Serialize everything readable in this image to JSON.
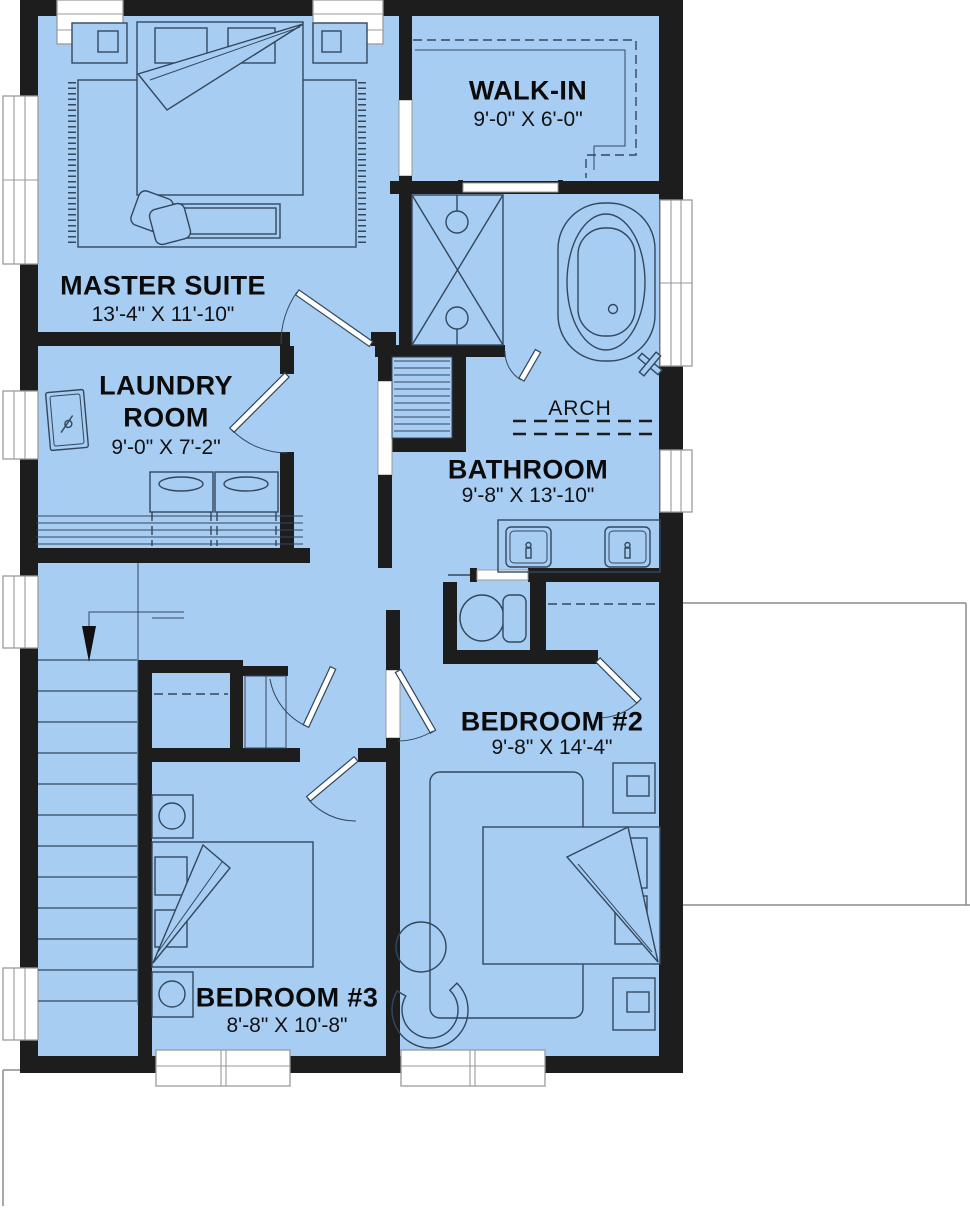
{
  "palette": {
    "floor": "#a8cdf3",
    "wall": "#1d1d1d",
    "line": "#33475c",
    "frame": "#9a9a9a",
    "outline": "#8c8c8c",
    "text": "#0b0b0b"
  },
  "rooms": {
    "master": {
      "name": "MASTER SUITE",
      "dims": "13'-4\" X 11'-10\""
    },
    "walkin": {
      "name": "WALK-IN",
      "dims": "9'-0\" X 6'-0\""
    },
    "laundry": {
      "name_line1": "LAUNDRY",
      "name_line2": "ROOM",
      "dims": "9'-0\" X 7'-2\""
    },
    "bathroom": {
      "name": "BATHROOM",
      "dims": "9'-8\" X 13'-10\""
    },
    "bedroom2": {
      "name": "BEDROOM #2",
      "dims": "9'-8\" X 14'-4\""
    },
    "bedroom3": {
      "name": "BEDROOM #3",
      "dims": "8'-8\" X 10'-8\""
    }
  },
  "annotations": {
    "arch": "ARCH"
  },
  "fixtures": [
    "double-bed",
    "area-rug",
    "bench",
    "throw-pillow",
    "nightstand",
    "closet-rod",
    "linen-shelves",
    "shower",
    "bathtub",
    "towel-bar",
    "double-vanity",
    "sink",
    "toilet",
    "washer",
    "dryer",
    "laundry-sink",
    "staircase",
    "down-arrow",
    "door",
    "window",
    "armchair",
    "side-table"
  ]
}
